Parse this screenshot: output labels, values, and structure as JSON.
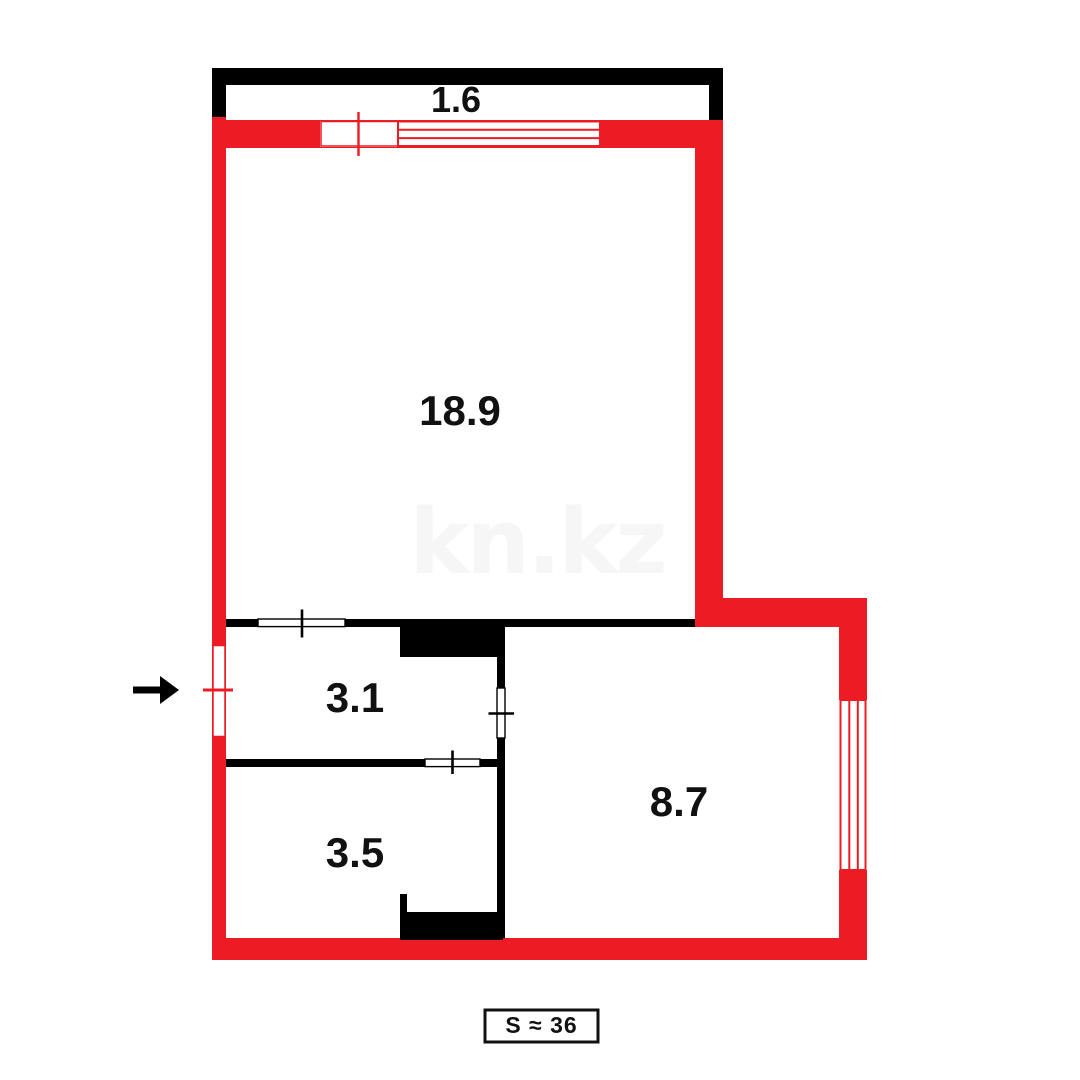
{
  "plan": {
    "type": "floor-plan",
    "watermark": "kn.kz",
    "total_area": {
      "label": "S ≈ 36"
    },
    "rooms": [
      {
        "name": "balcony",
        "area_label": "1.6"
      },
      {
        "name": "living-room",
        "area_label": "18.9"
      },
      {
        "name": "hallway",
        "area_label": "3.1"
      },
      {
        "name": "bathroom",
        "area_label": "3.5"
      },
      {
        "name": "kitchen",
        "area_label": "8.7"
      }
    ],
    "colors": {
      "wall_red": "#ED1C24",
      "wall_black": "#000000",
      "watermark_gray": "#F6F6F6",
      "background": "#FFFFFF"
    }
  }
}
